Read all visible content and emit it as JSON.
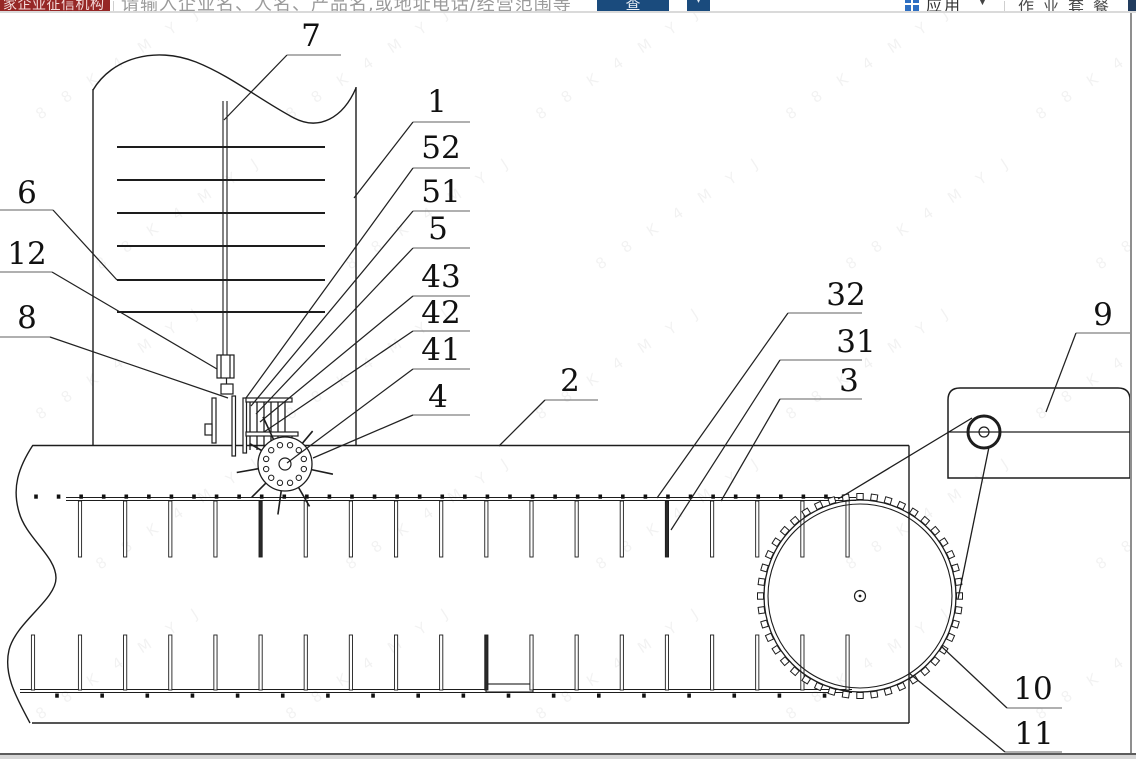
{
  "toolbar": {
    "badge": "家企业征信机构",
    "search_placeholder": "请输入企业名、人名、产品名,或地址电话/经营范围等",
    "search_button": "查",
    "secondary_button": "▾",
    "apps_label": "应用",
    "apps_caret": "▼",
    "package_label": "作业套餐",
    "accent_blue": "#1a4b7d",
    "badge_red": "#962726",
    "icon_blue": "#2e6fc2"
  },
  "watermark": {
    "text": "8 8 K 4 M Y J"
  },
  "figure": {
    "description": "patent mechanical drawing - trough conveyor with stirring tank, metering wheel, drive sprocket and motor",
    "labels": [
      {
        "n": "7",
        "x": 311,
        "y": 46,
        "u": [
          287,
          341,
          55
        ],
        "p": [
          224,
          120
        ]
      },
      {
        "n": "1",
        "x": 437,
        "y": 112,
        "u": [
          413,
          470,
          122
        ],
        "p": [
          354,
          198
        ]
      },
      {
        "n": "52",
        "x": 441,
        "y": 158,
        "u": [
          413,
          470,
          168
        ],
        "p": [
          246,
          398
        ]
      },
      {
        "n": "51",
        "x": 441,
        "y": 202,
        "u": [
          413,
          470,
          211
        ],
        "p": [
          251,
          406
        ]
      },
      {
        "n": "5",
        "x": 438,
        "y": 239,
        "u": [
          413,
          470,
          248
        ],
        "p": [
          256,
          414
        ]
      },
      {
        "n": "43",
        "x": 441,
        "y": 287,
        "u": [
          413,
          470,
          296
        ],
        "p": [
          260,
          422
        ]
      },
      {
        "n": "42",
        "x": 441,
        "y": 323,
        "u": [
          413,
          470,
          331
        ],
        "p": [
          264,
          432
        ]
      },
      {
        "n": "41",
        "x": 441,
        "y": 360,
        "u": [
          413,
          470,
          369
        ],
        "p": [
          287,
          463
        ]
      },
      {
        "n": "4",
        "x": 438,
        "y": 407,
        "u": [
          413,
          470,
          415
        ],
        "p": [
          313,
          458
        ]
      },
      {
        "n": "2",
        "x": 570,
        "y": 391,
        "u": [
          545,
          598,
          400
        ],
        "p": [
          499,
          446
        ]
      },
      {
        "n": "32",
        "x": 846,
        "y": 305,
        "u": [
          788,
          862,
          313
        ],
        "p": [
          657,
          498
        ]
      },
      {
        "n": "31",
        "x": 856,
        "y": 352,
        "u": [
          780,
          862,
          360
        ],
        "p": [
          671,
          530
        ]
      },
      {
        "n": "3",
        "x": 849,
        "y": 391,
        "u": [
          780,
          862,
          399
        ],
        "p": [
          721,
          501
        ]
      },
      {
        "n": "9",
        "x": 1103,
        "y": 325,
        "u": [
          1076,
          1131,
          333
        ],
        "p": [
          1046,
          412
        ]
      },
      {
        "n": "10",
        "x": 1033,
        "y": 699,
        "u": [
          1007,
          1062,
          708
        ],
        "p": [
          941,
          646
        ]
      },
      {
        "n": "11",
        "x": 1034,
        "y": 744,
        "u": [
          1005,
          1062,
          752
        ],
        "p": [
          909,
          673
        ]
      },
      {
        "n": "6",
        "x": 27,
        "y": 203,
        "u": [
          0,
          53,
          210
        ],
        "p": [
          117,
          280
        ]
      },
      {
        "n": "12",
        "x": 27,
        "y": 264,
        "u": [
          0,
          52,
          272
        ],
        "p": [
          217,
          369
        ]
      },
      {
        "n": "8",
        "x": 27,
        "y": 328,
        "u": [
          0,
          50,
          337
        ],
        "p": [
          228,
          398
        ]
      }
    ]
  }
}
